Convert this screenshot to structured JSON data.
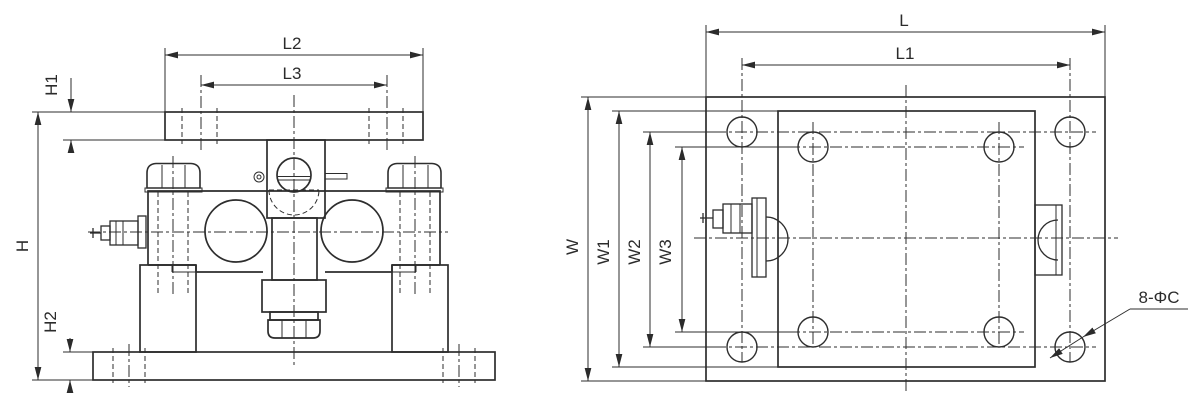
{
  "drawing": {
    "type": "engineering-dimension-drawing",
    "subject": "load-cell weighing module, front view and top view",
    "colors": {
      "line": "#2d2d2d",
      "background": "#ffffff"
    },
    "front_view": {
      "dims": {
        "overall_height": "H",
        "top_plate_thickness": "H1",
        "base_plate_thickness": "H2",
        "top_plate_length": "L2",
        "top_plate_hole_spacing": "L3"
      }
    },
    "top_view": {
      "dims": {
        "overall_length": "L",
        "corner_hole_spacing_length": "L1",
        "overall_width": "W",
        "inner_plate_width": "W1",
        "corner_hole_spacing_width": "W2",
        "inner_hole_spacing_width": "W3"
      },
      "hole_callout": "8-ΦC"
    }
  }
}
